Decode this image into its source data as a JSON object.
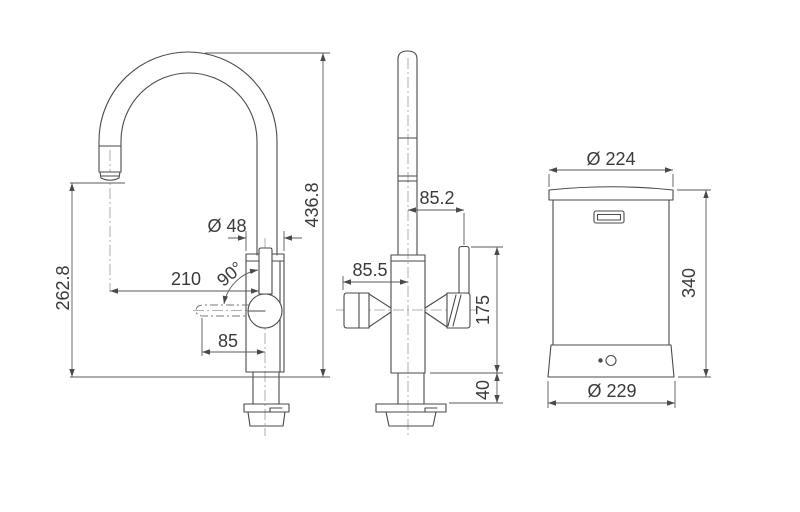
{
  "front_view": {
    "total_height": "436.8",
    "spout_height": "262.8",
    "body_diameter": "Ø 48",
    "spout_reach": "210",
    "handle_angle": "90°",
    "handle_length": "85"
  },
  "side_view": {
    "right_offset": "85.2",
    "left_offset": "85.5",
    "above_counter_height": "175",
    "shank_length": "40"
  },
  "tank_view": {
    "top_diameter": "Ø 224",
    "height": "340",
    "base_diameter": "Ø 229"
  },
  "colors": {
    "line": "#4a4a4a",
    "dimension": "#5a5a5a",
    "centerline": "#9a9a9a",
    "text": "#3a3a3a",
    "background": "#ffffff"
  }
}
